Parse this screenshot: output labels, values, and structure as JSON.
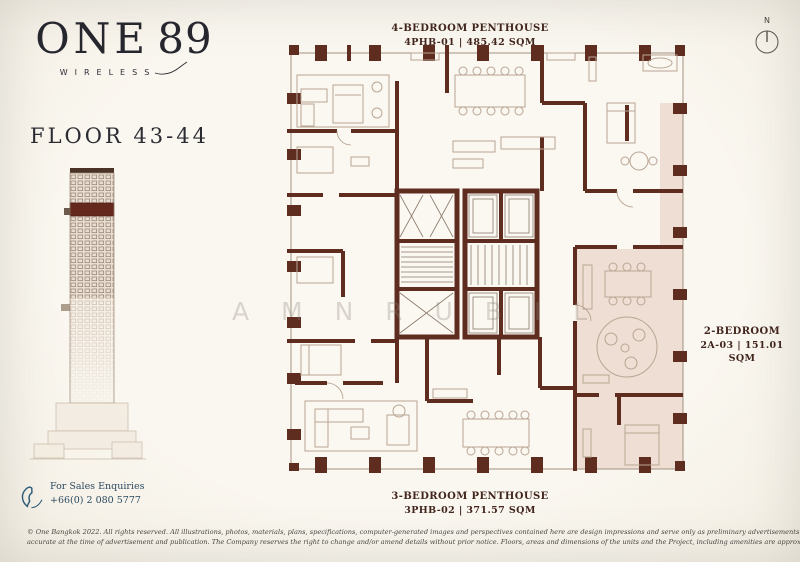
{
  "brand": {
    "logo_one": "ONE",
    "logo_num": "89",
    "logo_sub": "WIRELESS"
  },
  "floor": {
    "label": "FLOOR 43-44"
  },
  "compass": {
    "north": "N"
  },
  "unit_labels": {
    "top": {
      "name": "4-BEDROOM PENTHOUSE",
      "code": "4PHB-01 | 485.42 SQM"
    },
    "right": {
      "name": "2-BEDROOM",
      "code": "2A-03 | 151.01 SQM"
    },
    "bottom": {
      "name": "3-BEDROOM PENTHOUSE",
      "code": "3PHB-02 | 371.57 SQM"
    }
  },
  "contact": {
    "heading": "For Sales Enquiries",
    "phone": "+66(0) 2 080 5777"
  },
  "watermark": {
    "letters": "A M N R U B I L"
  },
  "disclaimer": {
    "line1": "© One Bangkok 2022. All rights reserved. All illustrations, photos, materials, plans, specifications, computer-generated images and perspectives contained here are design impressions and serve only as preliminary advertisements for general conceptual idea of the Project. Information provided is deemed",
    "line2": "accurate at the time of advertisement and publication. The Company reserves the right to change and/or amend details without prior notice. Floors, areas and dimensions of the units and the Project, including amenities are approximate and may be changed subject to final design and construction."
  },
  "colors": {
    "wall": "#5e2d20",
    "paper": "#f8f4ec",
    "highlight": "#eedbd0",
    "label_text": "#41251d",
    "contact_blue": "#2b4a60",
    "furniture": "#b9a593"
  }
}
